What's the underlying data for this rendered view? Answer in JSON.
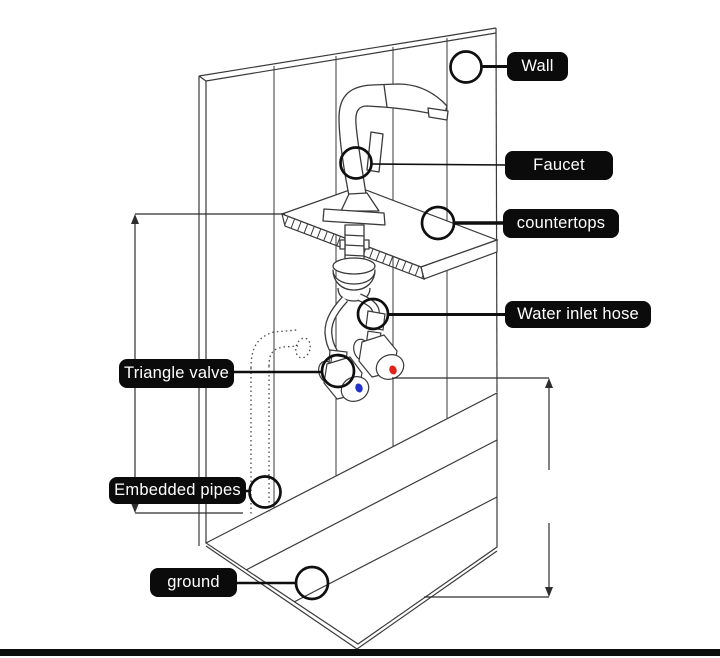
{
  "labels": {
    "wall": "Wall",
    "faucet": "Faucet",
    "countertops": "countertops",
    "water_inlet_hose": "Water inlet hose",
    "triangle_valve": "Triangle valve",
    "embedded_pipes": "Embedded pipes",
    "ground": "ground"
  },
  "colors": {
    "label_bg": "#0b0b0b",
    "label_text": "#ffffff",
    "cold_indicator": "#2233cc",
    "hot_indicator": "#e02318",
    "line": "#3a3a3a",
    "callout": "#0f0f0f"
  }
}
